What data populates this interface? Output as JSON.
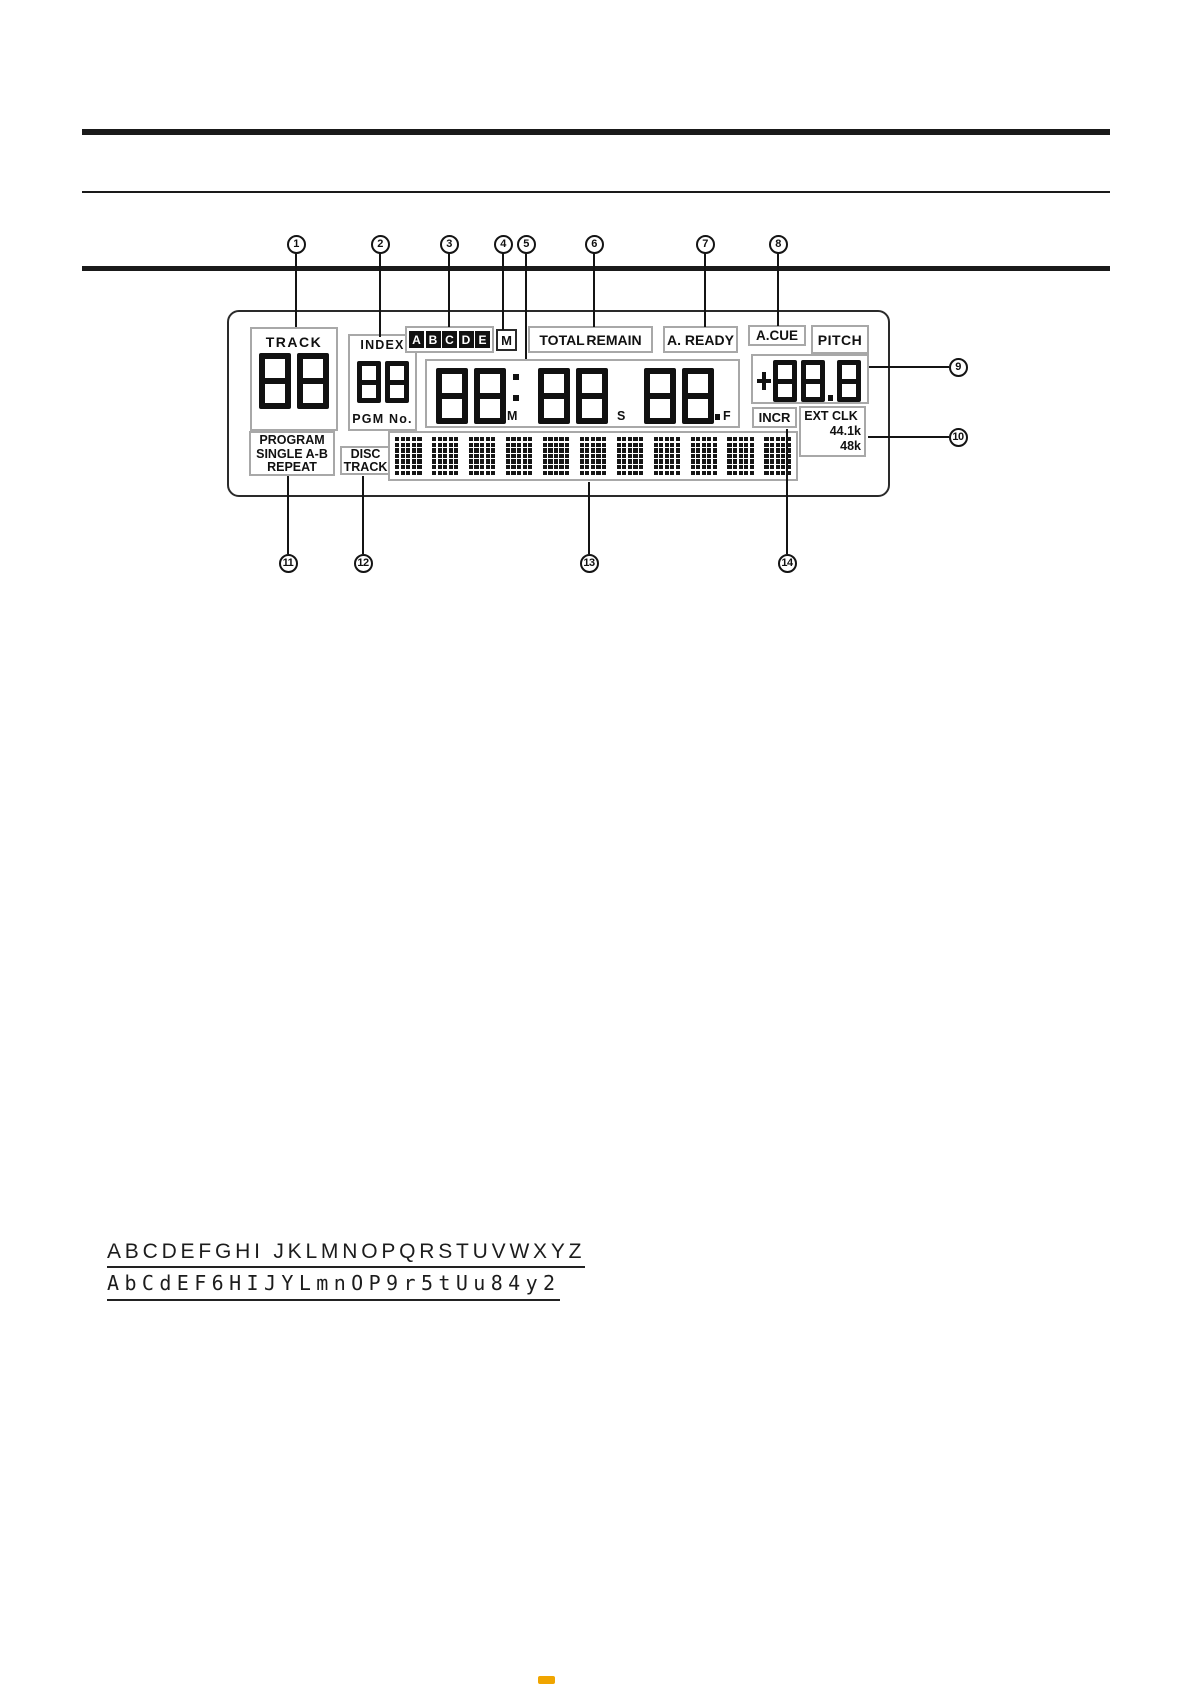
{
  "figure": {
    "display": {
      "track_label": "TRACK",
      "track_digits": "88",
      "mode_lines": [
        "PROGRAM",
        "SINGLE A-B",
        "REPEAT"
      ],
      "index_label": "INDEX",
      "index_digits": "88",
      "pgm_label": "PGM No.",
      "cue_letters": [
        "A",
        "B",
        "C",
        "D",
        "E"
      ],
      "m_indicator": "M",
      "total_remain_label": "TOTAL REMAIN",
      "a_ready_label": "A. READY",
      "a_cue_label": "A.CUE",
      "pitch_label": "PITCH",
      "pitch_digits": "88.8",
      "time": {
        "m_digits": "88",
        "s_digits": "88",
        "f_digits": "88",
        "m_label": "M",
        "s_label": "S",
        "f_label": "F"
      },
      "disc_label": "DISC",
      "disc_track_label": "TRACK",
      "incr_label": "INCR",
      "ext_clk_label": "EXT CLK",
      "clk_rate_1": "44.1k",
      "clk_rate_2": "48k",
      "matrix_cells": 11
    },
    "callouts": {
      "top_row_y": 244,
      "top": [
        {
          "n": "1",
          "x": 296,
          "to": 327
        },
        {
          "n": "2",
          "x": 380,
          "to": 337
        },
        {
          "n": "3",
          "x": 449,
          "to": 327
        },
        {
          "n": "4",
          "x": 503,
          "to": 330
        },
        {
          "n": "5",
          "x": 526,
          "to": 359
        },
        {
          "n": "6",
          "x": 594,
          "to": 327
        },
        {
          "n": "7",
          "x": 705,
          "to": 327
        },
        {
          "n": "8",
          "x": 778,
          "to": 326
        }
      ],
      "right_col_x": 958,
      "right": [
        {
          "n": "9",
          "y": 367,
          "from": 869
        },
        {
          "n": "10",
          "y": 437,
          "from": 868
        }
      ],
      "bottom_row_y": 563,
      "bottom": [
        {
          "n": "11",
          "x": 288,
          "from": 476
        },
        {
          "n": "12",
          "x": 363,
          "from": 476
        },
        {
          "n": "13",
          "x": 589,
          "from": 482
        },
        {
          "n": "14",
          "x": 787,
          "from": 429
        }
      ]
    }
  },
  "alphabet": {
    "plain_row": "ABCDEFGHI JKLMNOPQRSTUVWXYZ",
    "segment_row": "AbCdEF6HIJYLmnOP9r5tUu84y2"
  },
  "colors": {
    "segment": "#111111",
    "box_border": "#a8a8a8",
    "line_black": "#1a1a1a",
    "highlight": "#f0a500"
  }
}
